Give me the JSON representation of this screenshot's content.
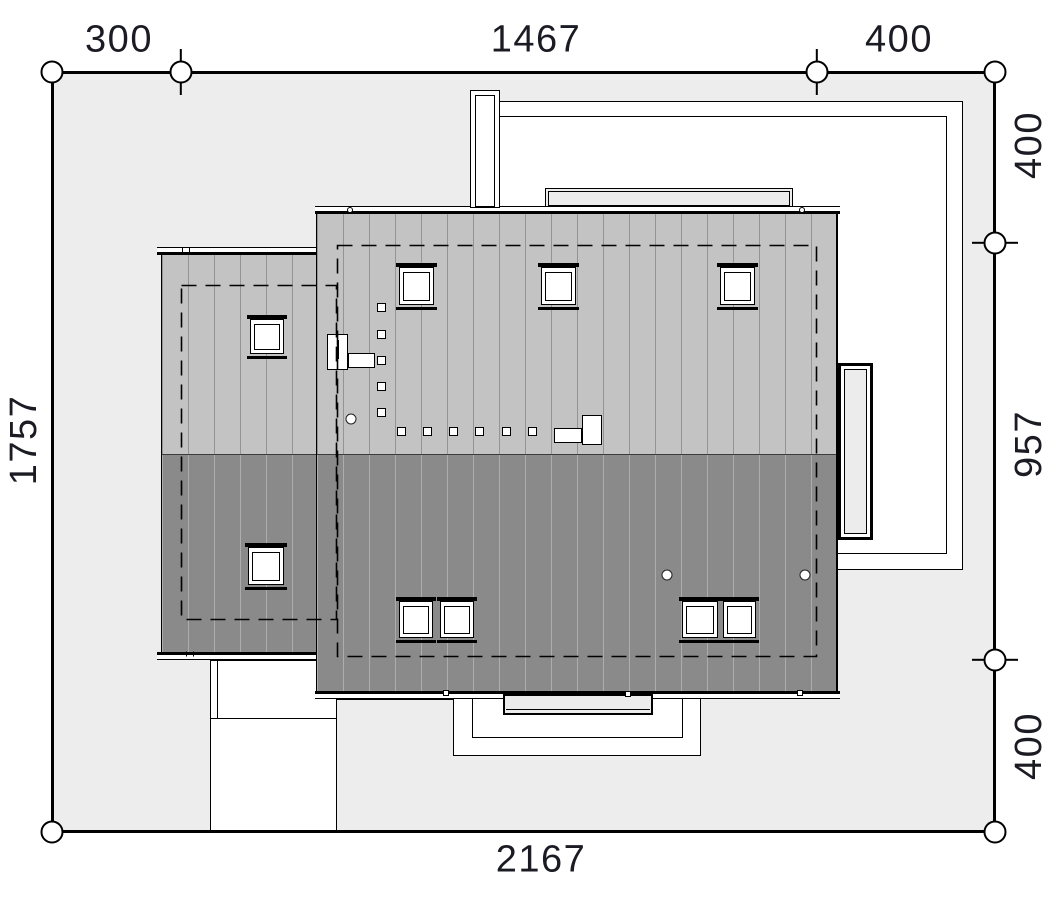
{
  "drawing": {
    "title": "site-plan-roof-view",
    "colors": {
      "site_fill": "#ededed",
      "roof_light": "#c3c3c3",
      "roof_dark": "#8a8a8a",
      "accent_fill": "#ececec",
      "line": "#000000",
      "label": "#1b1b24"
    },
    "dimensions": {
      "top": [
        "300",
        "1467",
        "400"
      ],
      "right": [
        "400",
        "957",
        "400"
      ],
      "left": [
        "1757"
      ],
      "bottom": [
        "2167"
      ]
    }
  },
  "plan": {
    "dim_labels": [
      {
        "id": "dim-top-300",
        "text": "300",
        "x": 119,
        "y": 41,
        "rot": 0
      },
      {
        "id": "dim-top-1467",
        "text": "1467",
        "x": 536,
        "y": 41,
        "rot": 0
      },
      {
        "id": "dim-top-400",
        "text": "400",
        "x": 899,
        "y": 41,
        "rot": 0
      },
      {
        "id": "dim-right-400a",
        "text": "400",
        "x": 1029,
        "y": 145,
        "rot": -90
      },
      {
        "id": "dim-right-957",
        "text": "957",
        "x": 1029,
        "y": 444,
        "rot": -90
      },
      {
        "id": "dim-right-400b",
        "text": "400",
        "x": 1029,
        "y": 746,
        "rot": -90
      },
      {
        "id": "dim-left-1757",
        "text": "1757",
        "x": 24,
        "y": 440,
        "rot": -90
      },
      {
        "id": "dim-bottom-2167",
        "text": "2167",
        "x": 541,
        "y": 861,
        "rot": 0
      }
    ],
    "markers": {
      "corners": [
        [
          52,
          72
        ],
        [
          995,
          72
        ],
        [
          52,
          832
        ],
        [
          995,
          832
        ]
      ],
      "ticked": [
        {
          "x": 181,
          "y": 72,
          "dir": "v"
        },
        {
          "x": 817,
          "y": 72,
          "dir": "v"
        },
        {
          "x": 995,
          "y": 243,
          "dir": "h"
        },
        {
          "x": 995,
          "y": 660,
          "dir": "h"
        }
      ]
    },
    "skylights": [
      [
        399,
        263,
        35,
        47
      ],
      [
        541,
        263,
        35,
        47
      ],
      [
        720,
        263,
        35,
        47
      ],
      [
        250,
        315,
        34,
        44
      ],
      [
        248,
        543,
        36,
        47
      ],
      [
        399,
        597,
        34,
        46
      ],
      [
        440,
        597,
        34,
        46
      ],
      [
        682,
        597,
        36,
        46
      ],
      [
        723,
        597,
        33,
        46
      ]
    ],
    "step_squares": [
      [
        377,
        303
      ],
      [
        377,
        330
      ],
      [
        377,
        356
      ],
      [
        377,
        382
      ],
      [
        377,
        408
      ],
      [
        397,
        427
      ],
      [
        423,
        427
      ],
      [
        449,
        427
      ],
      [
        475,
        427
      ],
      [
        502,
        427
      ],
      [
        528,
        427
      ]
    ],
    "vents": [
      [
        351,
        419
      ],
      [
        667,
        575
      ],
      [
        805,
        575
      ]
    ],
    "eave_dots": [
      [
        350,
        210
      ],
      [
        802,
        210
      ]
    ],
    "eave_squares": [
      [
        446,
        693
      ],
      [
        628,
        694
      ],
      [
        800,
        693
      ]
    ],
    "eave_ticks": [
      [
        186,
        250
      ],
      [
        190,
        654
      ]
    ]
  }
}
